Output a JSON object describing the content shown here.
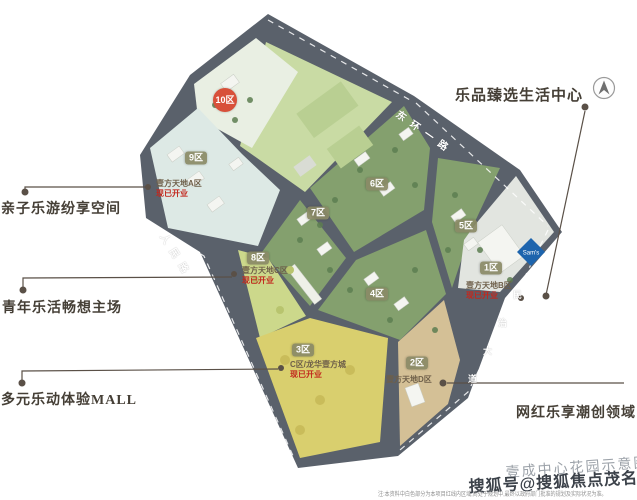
{
  "map": {
    "districts": [
      {
        "label": "10区",
        "highlight": true
      },
      {
        "label": "9区"
      },
      {
        "label": "6区"
      },
      {
        "label": "7区"
      },
      {
        "label": "5区"
      },
      {
        "label": "8区"
      },
      {
        "label": "1区"
      },
      {
        "label": "4区"
      },
      {
        "label": "3区"
      },
      {
        "label": "2区"
      }
    ],
    "roads": [
      {
        "name": "东环一路"
      },
      {
        "name": "人民路"
      },
      {
        "name": "民治大道",
        "chars": [
          "民",
          "治",
          "大",
          "道"
        ]
      }
    ],
    "poi_labels": [
      {
        "name": "壹方天地A区",
        "status": "现已开业"
      },
      {
        "name": "壹方天地C区",
        "status": "现已开业"
      },
      {
        "name": "壹方天地B区",
        "status": "现已开业"
      },
      {
        "name": "C区/龙华壹方城",
        "status": "现已开业"
      },
      {
        "name": "壹方天地D区",
        "status": ""
      }
    ],
    "sams_label": "Sam's"
  },
  "callouts": {
    "top_right": "乐品臻选生活中心",
    "left_top": "亲子乐游纷享空间",
    "left_middle": "青年乐活畅想主场",
    "left_bottom": "多元乐动体验MALL",
    "bottom_right": "网红乐享潮创领域"
  },
  "footer": {
    "caption": "壹成中心花园示意图",
    "watermark": "搜狐号@搜狐焦点茂名站",
    "note": "注:本资料中白色部分为本项目红线内区域,尚处于规划中,最终以政府部门批准的规划及实际状况为准。"
  },
  "colors": {
    "road": "#5a616b",
    "field_green": "#c9dba4",
    "district_teal": "#dde9e5",
    "district_lime": "#ccd88b",
    "district_yellow": "#d9cf6e",
    "district_tan": "#d4c096",
    "district_green": "#84a06e",
    "district_gray": "#e2e5e0",
    "badge_olive": "#8a8a66",
    "badge_red": "#d8503a",
    "status_red": "#c2281e",
    "sams_blue": "#1d64ad",
    "callout_text": "#453f36"
  }
}
